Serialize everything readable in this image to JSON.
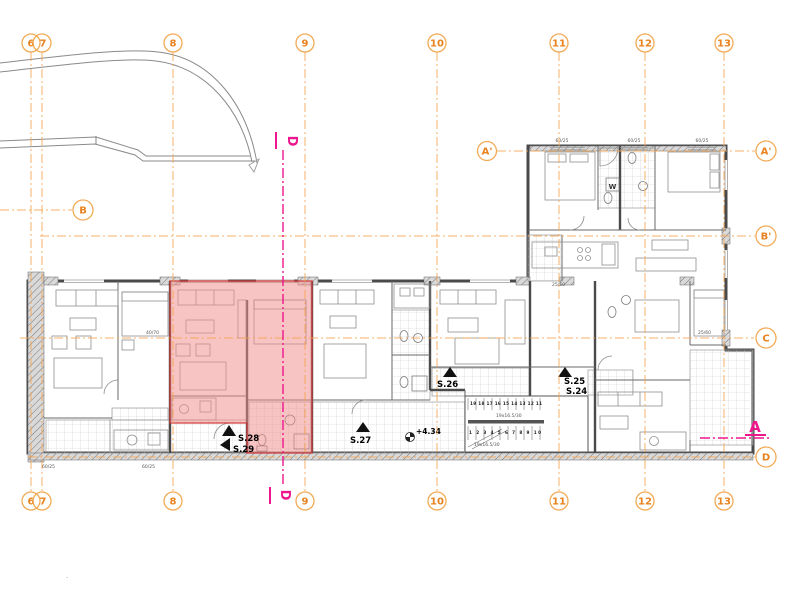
{
  "drawing": {
    "type": "architectural-floor-plan",
    "colors": {
      "grid_line": "#f2a44c",
      "bubble_text": "#e8821e",
      "section_marker": "#ee168d",
      "highlight_fill": "#f08c8c",
      "highlight_stroke": "#cf3a3a",
      "wall": "#4a4a4a"
    }
  },
  "grid": {
    "cols": [
      {
        "label": "6"
      },
      {
        "label": "7"
      },
      {
        "label": "8"
      },
      {
        "label": "9"
      },
      {
        "label": "10"
      },
      {
        "label": "11"
      },
      {
        "label": "12"
      },
      {
        "label": "13"
      }
    ],
    "rows": {
      "a_prime": "A'",
      "b": "B",
      "b_prime": "B'",
      "c": "C",
      "d": "D"
    }
  },
  "units": {
    "s24": "S.24",
    "s25": "S.25",
    "s26": "S.26",
    "s27": "S.27",
    "s28": "S.28",
    "s29": "S.29"
  },
  "elevation": "+4.34",
  "stairs": {
    "upper_steps": "19 18 17 16 15 14 13 12 11",
    "lower_steps": "1 2 3 4 5 6 7 8 9 10",
    "spec": "19x16.5/30"
  },
  "sections": {
    "d": "D",
    "a": "A"
  },
  "dims": {
    "a": "60/25",
    "b": "25/50",
    "c": "40/70",
    "d": "25/60",
    "w": "W"
  },
  "misc": {
    "dot": "."
  }
}
